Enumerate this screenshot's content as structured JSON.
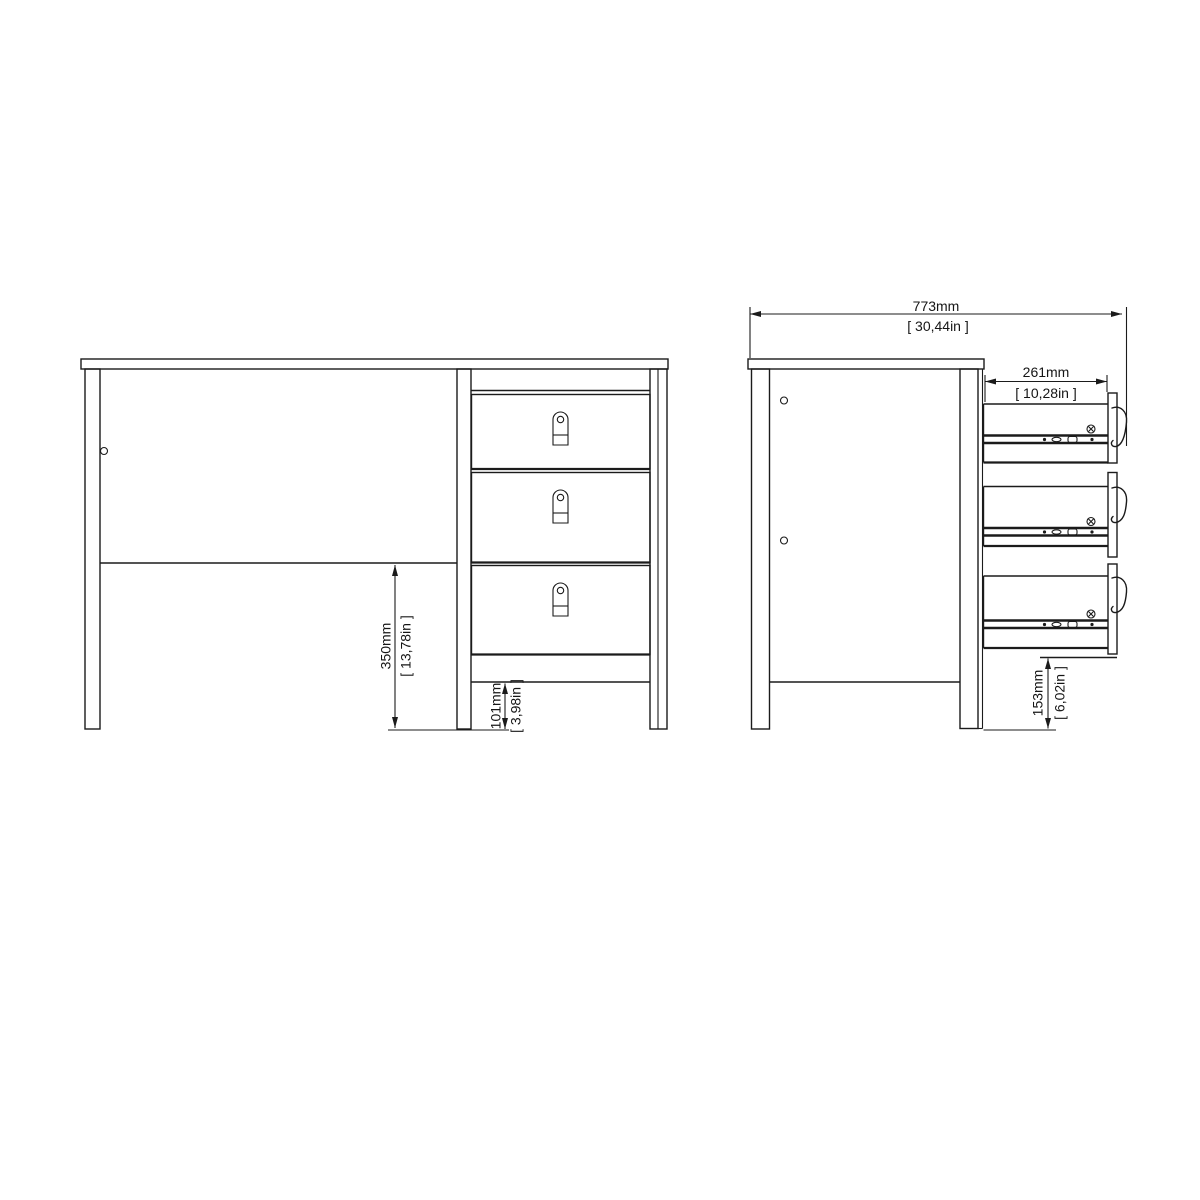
{
  "page": {
    "background": "#ffffff"
  },
  "drawing": {
    "kind": "furniture-dimension-diagram",
    "line_color": "#1b1b1b",
    "views": {
      "left": "front-view-desk-with-3-drawers",
      "right": "side-view-drawers-extended"
    },
    "dimensions": {
      "overall_depth": {
        "mm": "773mm",
        "in": "[ 30,44in ]"
      },
      "drawer_extension": {
        "mm": "261mm",
        "in": "[ 10,28in ]"
      },
      "under_desk_clearance": {
        "mm": "350mm",
        "in": "[ 13,78in ]"
      },
      "base_rail_clearance": {
        "mm": "101mm",
        "in": "[ 3,98in ]"
      },
      "drawer_bottom_clearance": {
        "mm": "153mm",
        "in": "[ 6,02in ]"
      }
    }
  }
}
